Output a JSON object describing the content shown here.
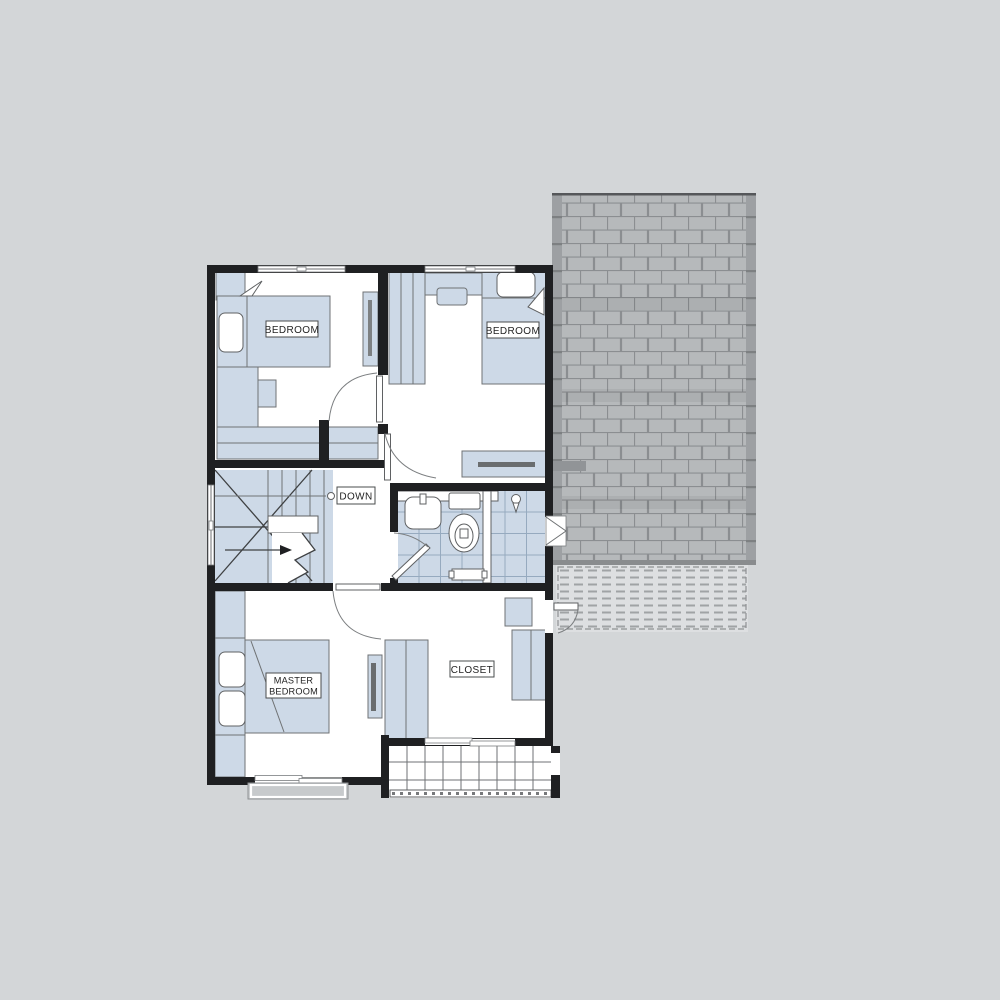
{
  "plan": {
    "type": "floor-plan",
    "labels": {
      "bedroom_left": "BEDROOM",
      "bedroom_right": "BEDROOM",
      "master_line1": "MASTER",
      "master_line2": "BEDROOM",
      "closet": "CLOSET",
      "stairs_down": "DOWN"
    },
    "rooms": [
      "BEDROOM",
      "BEDROOM",
      "MASTER BEDROOM",
      "CLOSET"
    ],
    "palette": {
      "background": "#d3d6d8",
      "wall": "#1f2022",
      "furniture_fill": "#cdd9e7",
      "furniture_stroke": "#6f7274",
      "roof_shingle": "#b6b9bb",
      "roof_joint_line": "#8b8e91",
      "roof_edge_band": "#9da0a3",
      "lower_roof_fill": "#dddfe1",
      "lower_roof_dash": "#a0a3a5",
      "bath_tile_line": "#96aabf",
      "label_text": "#232323",
      "label_border": "#4a4c4e",
      "planter_fill": "#c7cacc"
    }
  }
}
